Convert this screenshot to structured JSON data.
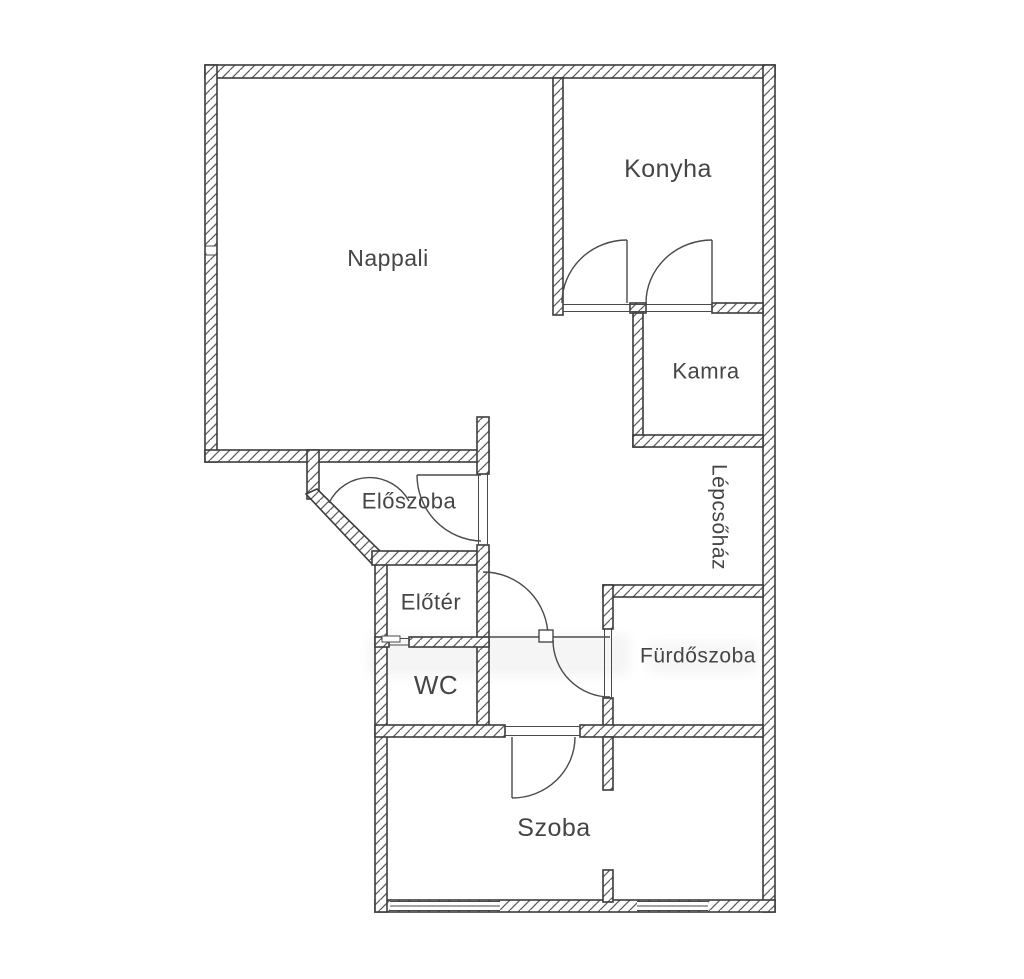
{
  "plan": {
    "type": "floor-plan",
    "language": "Hungarian",
    "colors": {
      "background": "#ffffff",
      "wall_outline": "#3c3c3c",
      "wall_hatch": "#5f5f5f",
      "door_line": "#4a4a4a",
      "label_text": "#454545"
    },
    "rooms": [
      {
        "id": "nappali",
        "label": "Nappali"
      },
      {
        "id": "konyha",
        "label": "Konyha"
      },
      {
        "id": "kamra",
        "label": "Kamra"
      },
      {
        "id": "lepcsohaz",
        "label": "Lépcsőház"
      },
      {
        "id": "eloszoba",
        "label": "Előszoba"
      },
      {
        "id": "eloter",
        "label": "Előtér"
      },
      {
        "id": "wc",
        "label": "WC"
      },
      {
        "id": "furdoszoba",
        "label": "Fürdőszoba"
      },
      {
        "id": "szoba",
        "label": "Szoba"
      }
    ]
  }
}
